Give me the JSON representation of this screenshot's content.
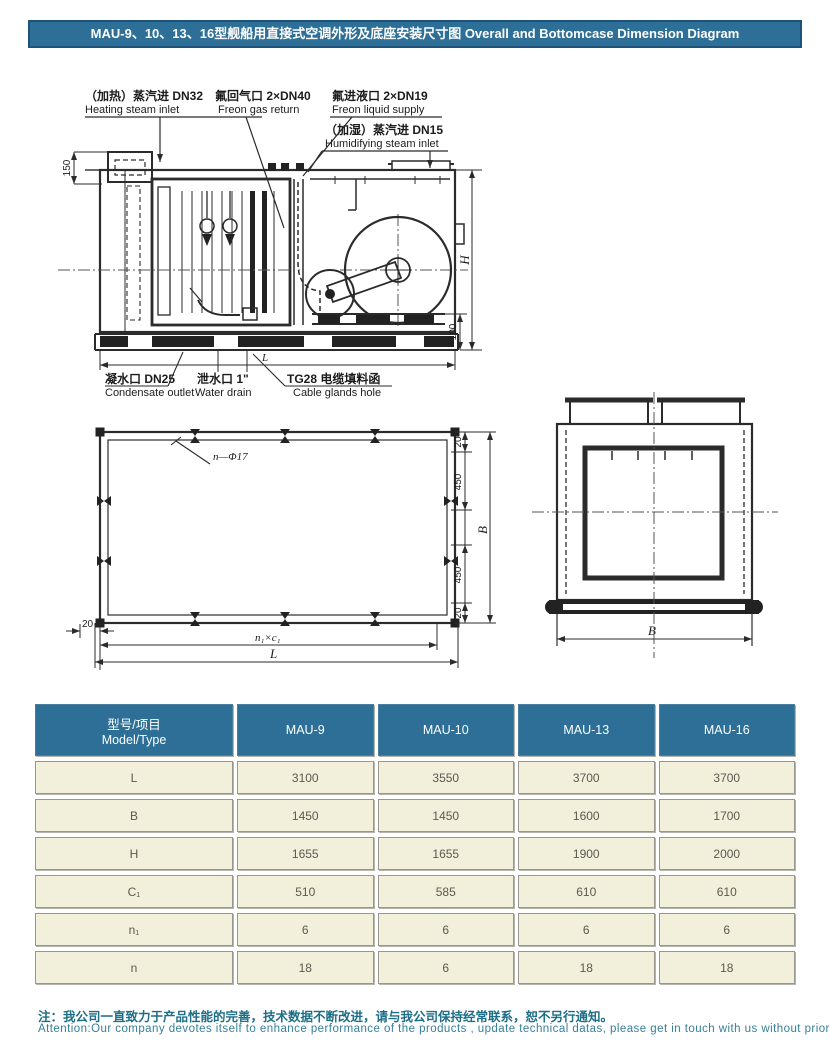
{
  "title": "MAU-9、10、13、16型舰船用直接式空调外形及底座安装尺寸图  Overall and Bottomcase Dimension Diagram",
  "side_view": {
    "heating_cn": "（加热）蒸汽进 DN32",
    "heating_en": "Heating steam inlet",
    "freon_gas_cn": "氟回气口 2×DN40",
    "freon_gas_en": "Freon gas return",
    "freon_liq_cn": "氟进液口 2×DN19",
    "freon_liq_en": "Freon liquid supply",
    "humid_cn": "（加湿）蒸汽进 DN15",
    "humid_en": "Humidifying steam inlet",
    "cond_cn": "凝水口 DN25",
    "cond_en": "Condensate outlet",
    "drain_cn": "泄水口 1\"",
    "drain_en": "Water drain",
    "cable_cn": "TG28 电缆填料函",
    "cable_en": "Cable glands hole",
    "dim_150": "150",
    "dim_H": "H",
    "dim_100": "100",
    "dim_L": "L"
  },
  "plan_view": {
    "holes": "n—Φ17",
    "dim_20": "20",
    "dim_450": "450",
    "dim_B": "B",
    "dim_n1c1": "n₁×c₁",
    "dim_L": "L"
  },
  "end_view": {
    "dim_B": "B"
  },
  "table": {
    "header": {
      "model_cn": "型号/项目",
      "model_en": "Model/Type",
      "cols": [
        "MAU-9",
        "MAU-10",
        "MAU-13",
        "MAU-16"
      ]
    },
    "rows": [
      {
        "label": "L",
        "values": [
          "3100",
          "3550",
          "3700",
          "3700"
        ]
      },
      {
        "label": "B",
        "values": [
          "1450",
          "1450",
          "1600",
          "1700"
        ]
      },
      {
        "label": "H",
        "values": [
          "1655",
          "1655",
          "1900",
          "2000"
        ]
      },
      {
        "label": "C₁",
        "values": [
          "510",
          "585",
          "610",
          "610"
        ]
      },
      {
        "label": "n₁",
        "values": [
          "6",
          "6",
          "6",
          "6"
        ]
      },
      {
        "label": "n",
        "values": [
          "18",
          "6",
          "18",
          "18"
        ]
      }
    ]
  },
  "note": {
    "cn": "注：我公司一直致力于产品性能的完善，技术数据不断改进，请与我公司保持经常联系，恕不另行通知。",
    "en": "Attention:Our company devotes itself to enhance performance of the products , update technical datas, please get in touch with us without prior notice"
  },
  "colors": {
    "header_blue": "#2d6f96",
    "cell_cream": "#f2efda",
    "note_teal": "#1d6e86"
  }
}
